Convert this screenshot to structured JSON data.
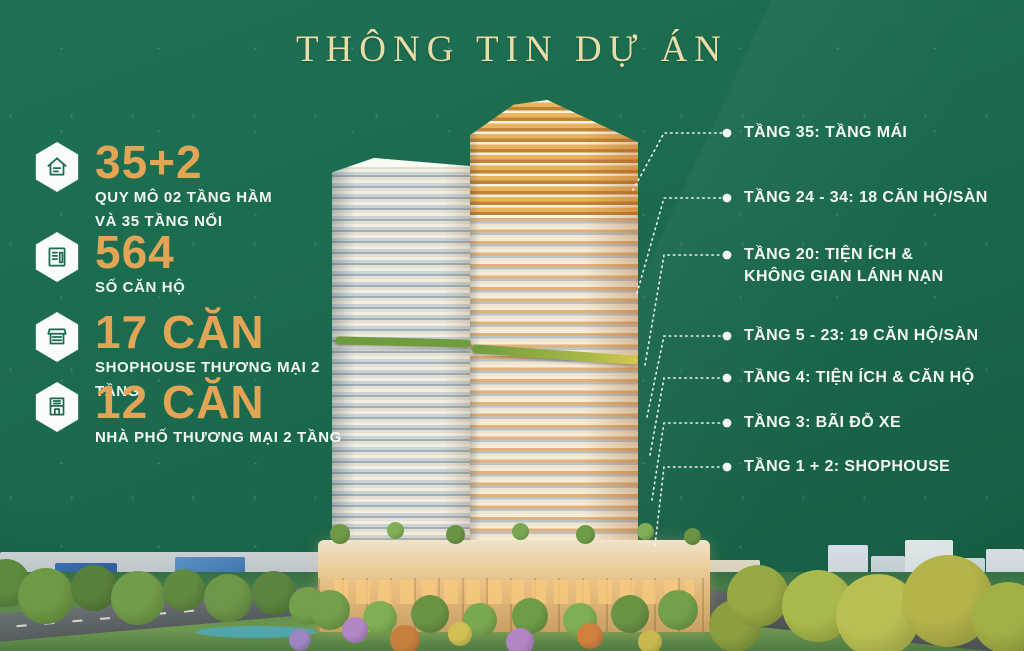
{
  "title": "THÔNG TIN DỰ ÁN",
  "colors": {
    "background": "#1b6a4e",
    "accent_gold": "#e2a455",
    "title_gold": "#eadca6",
    "text": "#f2f7f2"
  },
  "stats": [
    {
      "icon": "scale-house-icon",
      "value": "35+2",
      "lines": [
        "QUY MÔ 02 TẦNG HẦM",
        "VÀ 35 TẦNG NỔI"
      ]
    },
    {
      "icon": "apartment-units-icon",
      "value": "564",
      "lines": [
        "SỐ CĂN HỘ"
      ]
    },
    {
      "icon": "shophouse-icon",
      "value": "17 CĂN",
      "lines": [
        "SHOPHOUSE THƯƠNG MẠI 2 TẦNG"
      ]
    },
    {
      "icon": "townhouse-icon",
      "value": "12 CĂN",
      "lines": [
        "NHÀ PHỐ THƯƠNG MẠI 2 TẦNG"
      ]
    }
  ],
  "callouts": [
    {
      "lines": [
        "TẦNG 35: TẦNG MÁI"
      ]
    },
    {
      "lines": [
        "TẦNG 24 - 34: 18 CĂN HỘ/SÀN"
      ]
    },
    {
      "lines": [
        "TẦNG 20: TIỆN ÍCH &",
        "KHÔNG GIAN LÁNH NẠN"
      ]
    },
    {
      "lines": [
        "TẦNG 5 - 23: 19 CĂN HỘ/SÀN"
      ]
    },
    {
      "lines": [
        "TẦNG 4: TIỆN ÍCH & CĂN HỘ"
      ]
    },
    {
      "lines": [
        "TẦNG 3: BÃI ĐỖ XE"
      ]
    },
    {
      "lines": [
        "TẦNG 1 + 2: SHOPHOUSE"
      ]
    }
  ]
}
